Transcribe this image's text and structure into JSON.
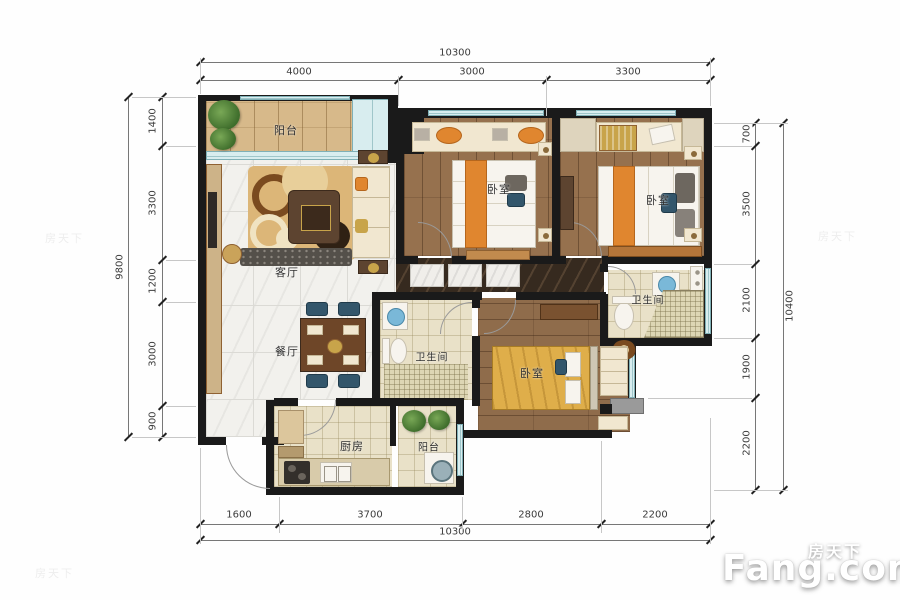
{
  "plan": {
    "rooms": {
      "balcony_top": "阳台",
      "living": "客厅",
      "dining": "餐厅",
      "bedroom_1": "卧室",
      "bedroom_2": "卧室",
      "bedroom_3": "卧室",
      "bath_1": "卫生间",
      "bath_2": "卫生间",
      "kitchen": "厨房",
      "balcony_bottom": "阳台"
    }
  },
  "dimensions": {
    "top": {
      "total": "10300",
      "segments": [
        "4000",
        "3000",
        "3300"
      ]
    },
    "bottom": {
      "total": "10300",
      "segments": [
        "1600",
        "3700",
        "2800",
        "2200"
      ]
    },
    "left": {
      "total": "9800",
      "segments": [
        "1400",
        "3300",
        "1200",
        "3000",
        "900"
      ]
    },
    "right": {
      "total": "10400",
      "segments": [
        "700",
        "3500",
        "2100",
        "1900",
        "2200"
      ]
    }
  },
  "watermark": {
    "cn": "房天下",
    "en": "Fang.com",
    "faint": "房天下"
  },
  "colors": {
    "wall": "#1a1a1a",
    "marble": "#f2f1ed",
    "wood": "#96714e",
    "deck": "#d7b98a",
    "hall_marble": "#362a1f",
    "tile": "#e9e1c8",
    "window": "#d8edef",
    "accent_orange": "#e0862f",
    "accent_teal": "#33566b",
    "bed_gold": "#dfae4a"
  }
}
